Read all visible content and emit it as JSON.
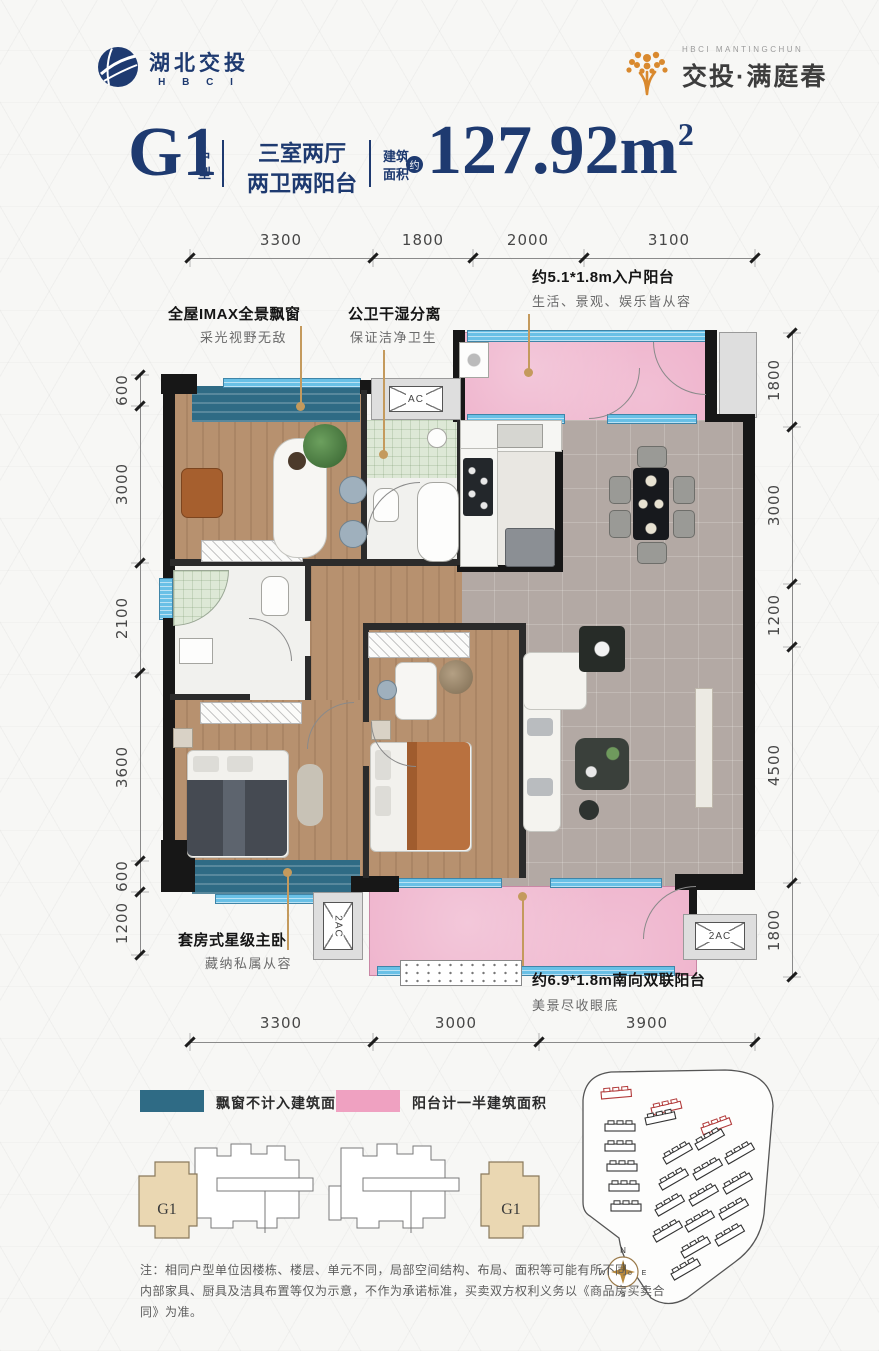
{
  "brand": {
    "left_logo": {
      "name": "湖北交投",
      "sub": "H B C I"
    },
    "right_logo": {
      "small": "HBCI MANTINGCHUN",
      "name": "交投·满庭春"
    }
  },
  "title": {
    "unit": "G1",
    "unit_suffix": "户型",
    "layout_line1": "三室两厅",
    "layout_line2": "两卫两阳台",
    "area_label_line1": "建筑",
    "area_label_line2": "面积",
    "approx": "约",
    "area_value": "127.92m",
    "area_sup": "2"
  },
  "dimensions": {
    "top": [
      "3300",
      "1800",
      "2000",
      "3100"
    ],
    "bottom": [
      "3300",
      "3000",
      "3900"
    ],
    "left": [
      "600",
      "3000",
      "2100",
      "3600",
      "600",
      "1200"
    ],
    "right": [
      "1800",
      "3000",
      "1200",
      "4500",
      "1800"
    ]
  },
  "annotations": [
    {
      "title": "全屋IMAX全景飘窗",
      "desc": "采光视野无敌"
    },
    {
      "title": "公卫干湿分离",
      "desc": "保证洁净卫生"
    },
    {
      "title": "约5.1*1.8m入户阳台",
      "desc": "生活、景观、娱乐皆从容"
    },
    {
      "title": "套房式星级主卧",
      "desc": "藏纳私属从容"
    },
    {
      "title": "约6.9*1.8m南向双联阳台",
      "desc": "美景尽收眼底"
    }
  ],
  "plan_labels": {
    "ac": "AC",
    "ac2_left": "2AC",
    "ac2_right": "2AC"
  },
  "legend": [
    {
      "label": "飘窗不计入建筑面积",
      "color": "#2f6b85"
    },
    {
      "label": "阳台计一半建筑面积",
      "color": "#efa1c1"
    }
  ],
  "key_plan": {
    "unit_left": "G1",
    "unit_right": "G1"
  },
  "compass": {
    "n": "N",
    "s": "S",
    "e": "E",
    "w": "W"
  },
  "notes": [
    "注：相同户型单位因楼栋、楼层、单元不同，局部空间结构、布局、面积等可能有所不同。",
    "内部家具、厨具及洁具布置等仅为示意，不作为承诺标准，买卖双方权利义务以《商品房买卖合同》为准。"
  ],
  "colors": {
    "navy": "#1e3a70",
    "gold": "#c49a5d",
    "bay_window": "#2f6b85",
    "balcony_pink": "#efa1c1",
    "window_glass": "#69c0e6",
    "wall": "#171717",
    "wood": "#b7916f",
    "tile": "#b3a9a4",
    "brand_orange": "#d9892e"
  }
}
